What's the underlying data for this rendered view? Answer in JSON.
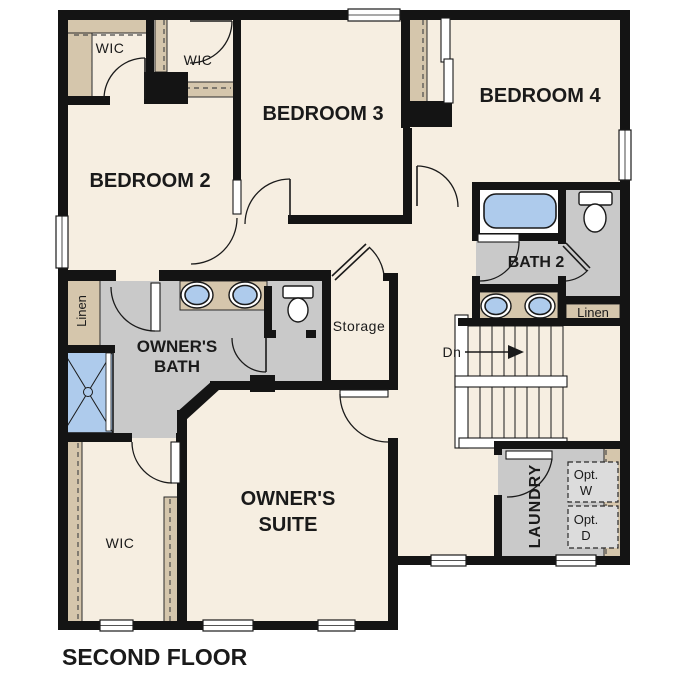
{
  "plan": {
    "floor_title": "SECOND FLOOR",
    "rooms": {
      "bedroom2": {
        "label": "BEDROOM 2"
      },
      "bedroom3": {
        "label": "BEDROOM 3"
      },
      "bedroom4": {
        "label": "BEDROOM 4"
      },
      "owners_suite": {
        "label_line1": "OWNER'S",
        "label_line2": "SUITE"
      },
      "owners_bath": {
        "label_line1": "OWNER'S",
        "label_line2": "BATH"
      },
      "bath2": {
        "label": "BATH 2"
      },
      "laundry": {
        "label": "LAUNDRY"
      },
      "storage": {
        "label": "Storage"
      },
      "wic_bedroom2": {
        "label": "WIC"
      },
      "wic_bedroom3": {
        "label": "WIC"
      },
      "wic_owners": {
        "label": "WIC"
      },
      "linen_owners": {
        "label": "Linen"
      },
      "linen_bath2": {
        "label": "Linen"
      }
    },
    "stairs": {
      "direction_label": "Dn"
    },
    "optional_appliances": {
      "washer_line1": "Opt.",
      "washer_line2": "W",
      "dryer_line1": "Opt.",
      "dryer_line2": "D"
    },
    "colors": {
      "background": "#ffffff",
      "floor_cream": "#f6eee1",
      "bath_floor_gray": "#c9c9c9",
      "closet_tan": "#d5c6ac",
      "fixture_blue": "#aecbec",
      "wall_black": "#141414",
      "optional_box_gray": "#dcdcdc"
    }
  }
}
